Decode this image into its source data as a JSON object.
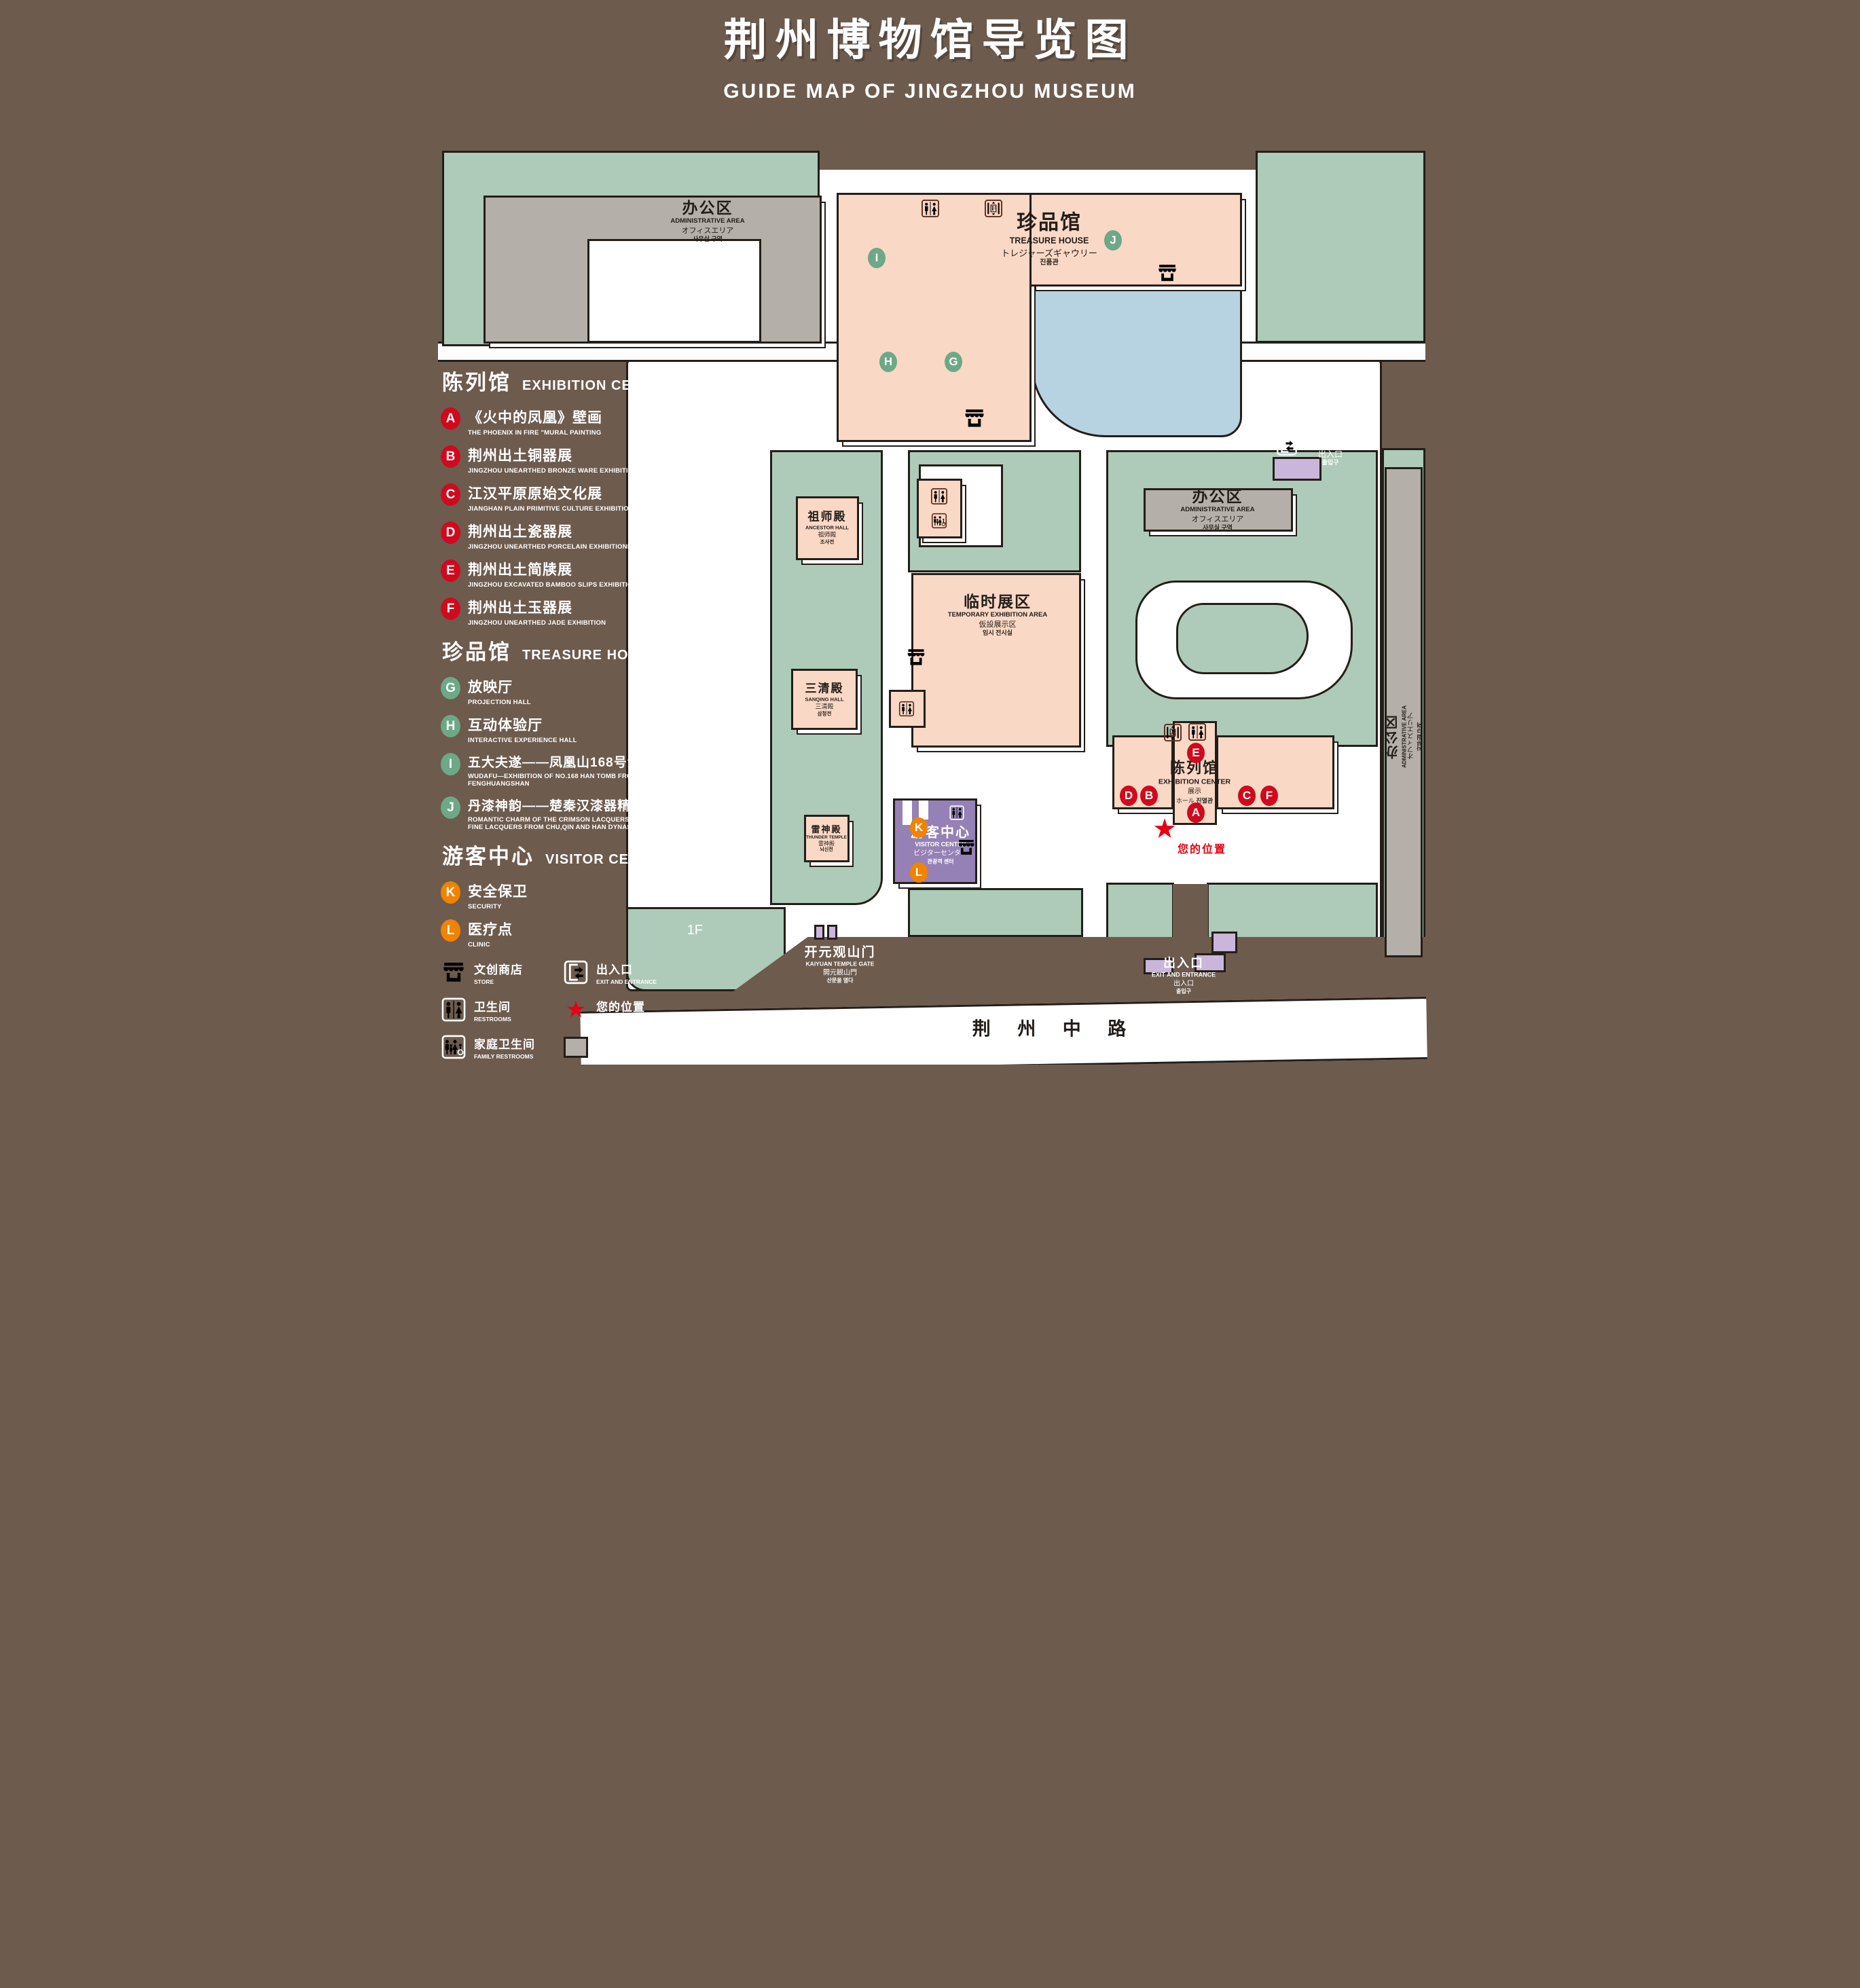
{
  "title": {
    "zh": "荆州博物馆导览图",
    "en": "GUIDE MAP OF JINGZHOU MUSEUM"
  },
  "legend": {
    "sections": [
      {
        "zh": "陈列馆",
        "en": "EXHIBITION CENTER",
        "marker_color": "#cf0a1e",
        "items": [
          {
            "id": "A",
            "zh": "《火中的凤凰》壁画",
            "en": "THE PHOENIX IN FIRE \"MURAL PAINTING",
            "floor": "1F"
          },
          {
            "id": "B",
            "zh": "荆州出土铜器展",
            "en": "JINGZHOU UNEARTHED BRONZE WARE EXHIBITION",
            "floor": "1F"
          },
          {
            "id": "C",
            "zh": "江汉平原原始文化展",
            "en": "JIANGHAN PLAIN PRIMITIVE CULTURE EXHIBITION",
            "floor": "1F"
          },
          {
            "id": "D",
            "zh": "荆州出土瓷器展",
            "en": "JINGZHOU UNEARTHED PORCELAIN EXHIBITIONE",
            "floor": "2F"
          },
          {
            "id": "E",
            "zh": "荆州出土简牍展",
            "en": "JINGZHOU EXCAVATED BAMBOO SLIPS EXHIBITION",
            "floor": "2F"
          },
          {
            "id": "F",
            "zh": "荆州出土玉器展",
            "en": "JINGZHOU UNEARTHED JADE EXHIBITION",
            "floor": "2F"
          }
        ]
      },
      {
        "zh": "珍品馆",
        "en": "TREASURE HOUSE",
        "marker_color": "#6da887",
        "items": [
          {
            "id": "G",
            "zh": "放映厅",
            "en": "PROJECTION HALL",
            "floor": "1F"
          },
          {
            "id": "H",
            "zh": "互动体验厅",
            "en": "INTERACTIVE EXPERIENCE HALL",
            "floor": "1F"
          },
          {
            "id": "I",
            "zh": "五大夫遂——凤凰山168号汉墓展",
            "en": "WUDAFU—EXHIBITION OF NO.168 HAN TOMB FROM FENGHUANGSHAN",
            "floor": "2F"
          },
          {
            "id": "J",
            "zh": "丹漆神韵——楚秦汉漆器精品展",
            "en": "ROMANTIC CHARM OF THE CRIMSON LACQUERS—EXHIBITIONS OF FINE LACQUERS FROM CHU,QIN AND HAN DYNASTIES",
            "floor": "1-2F"
          }
        ]
      },
      {
        "zh": "游客中心",
        "en": "VISITOR CENTER",
        "marker_color": "#f08300",
        "items": [
          {
            "id": "K",
            "zh": "安全保卫",
            "en": "SECURITY",
            "floor": "1F"
          },
          {
            "id": "L",
            "zh": "医疗点",
            "en": "CLINIC",
            "floor": "1F"
          }
        ]
      }
    ],
    "symbols": [
      {
        "icon": "store-icon",
        "zh": "文创商店",
        "en": "STORE"
      },
      {
        "icon": "exit-icon",
        "zh": "出入口",
        "en": "EXIT AND ENTRANCE"
      },
      {
        "icon": "restroom-icon",
        "zh": "卫生间",
        "en": "RESTROOMS"
      },
      {
        "icon": "your-location-icon",
        "zh": "您的位置",
        "en": "YOUR LOCATION"
      },
      {
        "icon": "family-restroom-icon",
        "zh": "家庭卫生间",
        "en": "FAMILY RESTROOMS"
      },
      {
        "icon": "office-area-swatch",
        "zh": "办公区域",
        "en": "OFFICE AREA"
      },
      {
        "icon": "accessible-elevator-icon",
        "zh": "无障碍电梯",
        "en": "ACCESSIBLE ELEVATOR"
      },
      {
        "icon": "display-area-swatch",
        "zh": "展示区域",
        "en": "DISPLAY AREA"
      },
      {
        "icon": "elevator-icon",
        "zh": "电梯",
        "en": "Elevator"
      }
    ]
  },
  "map": {
    "buildings": {
      "admin": {
        "zh": "办公区",
        "en": "ADMINISTRATIVE AREA",
        "ja": "オフィスエリア",
        "ko": "사무실 구역"
      },
      "treasure": {
        "zh": "珍品馆",
        "en": "TREASURE HOUSE",
        "ja": "トレジャーズギャウリー",
        "ko": "진품관"
      },
      "ancestor": {
        "zh": "祖师殿",
        "en": "ANCESTOR HALL",
        "ja": "祖师殿",
        "ko": "조사전"
      },
      "temporary": {
        "zh": "临时展区",
        "en": "TEMPORARY EXHIBITION AREA",
        "ja": "仮設展示区",
        "ko": "임시 전시실"
      },
      "sanqing": {
        "zh": "三清殿",
        "en": "SANQING HALL",
        "ja": "三清殿",
        "ko": "삼청전"
      },
      "thunder": {
        "zh": "雷神殿",
        "en": "THUNDER TEMPLE",
        "ja": "雷神殿",
        "ko": "뇌신전"
      },
      "visitor": {
        "zh": "游客中心",
        "en": "VISITOR CENTER",
        "ja": "ビジターセンター",
        "ko": "관광객 센터"
      },
      "exhibition": {
        "zh": "陈列馆",
        "en": "EXHIBITION CENTER",
        "ja": "展示",
        "ja2": "ホール",
        "ko": "진열관"
      },
      "gate": {
        "zh": "开元观山门",
        "en": "KAIYUAN TEMPLE GATE",
        "ja": "開元観山門",
        "ko": "산문을 열다"
      }
    },
    "exit": {
      "zh": "出入口",
      "en": "EXIT AND ENTRANCE",
      "ja": "出入口",
      "ko": "출입구"
    },
    "your_location": "您的位置",
    "road": "荆 州 中 路",
    "markers": {
      "A": "A",
      "B": "B",
      "C": "C",
      "D": "D",
      "E": "E",
      "F": "F",
      "G": "G",
      "H": "H",
      "I": "I",
      "J": "J",
      "K": "K",
      "L": "L"
    }
  },
  "colors": {
    "background": "#6d5b4e",
    "landscape_green": "#aecab8",
    "display_area": "#f9d8c5",
    "office_area": "#b5afaa",
    "pond_blue": "#b7d2e1",
    "visitor_center_purple": "#9581b5",
    "small_building_purple": "#c9b6da",
    "outline": "#241e19",
    "marker_red": "#cf0a1e",
    "marker_green": "#6da887",
    "marker_orange": "#f08300",
    "icon_maroon": "#5e2b1e",
    "location_red": "#e60012"
  }
}
